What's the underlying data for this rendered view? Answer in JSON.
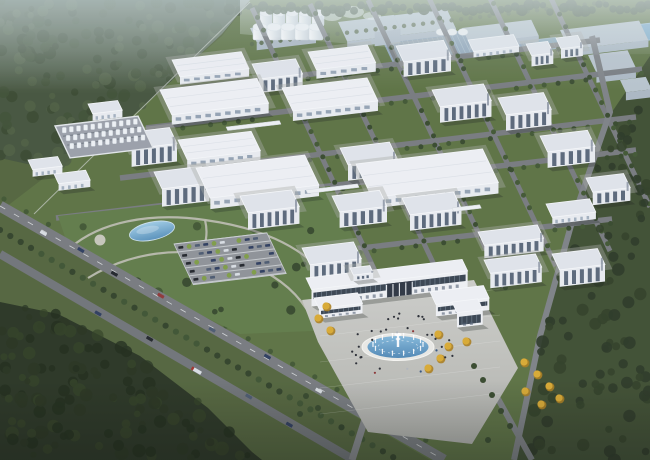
{
  "meta": {
    "description": "Aerial bird's-eye 3D architectural rendering of a large industrial park campus with rows of white factory and office buildings, a silo cluster, a tank yard, a landscaped entrance park with pond and parking lot, a main gate building with oval fountain plaza, tree-lined boulevards and surrounding forest and fields",
    "canvas": {
      "w": 650,
      "h": 460
    }
  },
  "palette": {
    "field": "#51633a",
    "campusGrass": "#5a7040",
    "parkGrass": "#5e7a46",
    "distantBase": "#a7b3b9",
    "distantRoof": "#95a9b8",
    "distantRoofTop": "#b7c3cc",
    "skylight": "#8ba2b6",
    "skylightLine": "#aabfcc",
    "forestTLBase": "#42523a",
    "forestTLDotA": "#36462e",
    "forestTLDotB": "#4b5c40",
    "forestBLBase": "#2c3a26",
    "forestBLDotA": "#22301d",
    "forestBLDotB": "#354627",
    "rightFieldBase": "#3c4c2f",
    "rightFieldDot": "#2e3d24",
    "treelineDot": "#3f503a",
    "road": "#75797d",
    "roadMinor": "#7c8084",
    "roadLane": "#e8eaec",
    "pathGrey": "#b9baae",
    "apron": "#cccdc8",
    "apronEdge": "#b0b1ac",
    "face": "#e8ebf0",
    "faceShade": "#c7cdd7",
    "roofLight": "#eef0f4",
    "roofMid": "#e0e4ea",
    "roofEdge": "#f6f8fa",
    "glass": "#4b5a6e",
    "glassLight": "#8495a8",
    "gateGlass": "#36424f",
    "water": "#4d86b4",
    "waterLight": "#83b8da",
    "pondDistant": "#78a9c8",
    "pondEdge": "#cfe2ee",
    "silo": "#eef2f5",
    "siloShade": "#c9d2d9",
    "yellow": "#d9a930",
    "yellowDark": "#a87c1c",
    "treeDark": "#34472a",
    "treeMid": "#3f5530",
    "bush": "#7d9b44",
    "carNavy": "#2b3a5c",
    "carBlack": "#1e2228",
    "carSlate": "#49586e",
    "carWhite": "#d9dee3",
    "carRed": "#8e3434",
    "truckRed": "#a03028",
    "tankFloor": "#999fa8",
    "pipe": "#6e7680",
    "people": "#262a31",
    "peopleAlt": [
      "#8a3030",
      "#31517c",
      "#b0b6bc"
    ],
    "shadow": "rgba(22,30,24,0.28)",
    "mist": "#cfdde2",
    "steam": "#e9f1f3"
  },
  "basis": {
    "u": [
      0.988,
      -0.118
    ],
    "v": [
      0.42,
      0.885
    ]
  },
  "terrain": {
    "forestTL": [
      [
        0,
        0
      ],
      [
        250,
        0
      ],
      [
        222,
        34
      ],
      [
        166,
        86
      ],
      [
        112,
        134
      ],
      [
        54,
        170
      ],
      [
        0,
        158
      ]
    ],
    "forestBL": [
      [
        0,
        302
      ],
      [
        58,
        314
      ],
      [
        140,
        356
      ],
      [
        208,
        408
      ],
      [
        252,
        452
      ],
      [
        262,
        460
      ],
      [
        0,
        460
      ]
    ],
    "rightField": [
      [
        650,
        56
      ],
      [
        612,
        112
      ],
      [
        574,
        222
      ],
      [
        542,
        336
      ],
      [
        516,
        460
      ],
      [
        650,
        460
      ]
    ],
    "campusPlate": [
      [
        250,
        0
      ],
      [
        650,
        0
      ],
      [
        650,
        56
      ],
      [
        612,
        112
      ],
      [
        574,
        222
      ],
      [
        542,
        336
      ],
      [
        516,
        460
      ],
      [
        430,
        460
      ],
      [
        2,
        210
      ],
      [
        36,
        184
      ],
      [
        96,
        138
      ],
      [
        160,
        90
      ],
      [
        222,
        36
      ]
    ],
    "distantBand": [
      [
        240,
        0
      ],
      [
        650,
        0
      ],
      [
        650,
        54
      ],
      [
        486,
        56
      ],
      [
        240,
        34
      ]
    ]
  },
  "distant": {
    "blocks": [
      [
        "grey",
        338,
        22,
        110,
        22,
        6
      ],
      [
        "grey",
        462,
        28,
        70,
        18,
        6
      ],
      [
        "grey",
        560,
        30,
        80,
        22,
        7
      ],
      [
        "grey",
        588,
        55,
        40,
        20,
        10
      ],
      [
        "grey",
        620,
        80,
        26,
        14,
        8
      ],
      [
        "grey",
        250,
        28,
        60,
        16,
        8
      ],
      [
        "grey",
        368,
        18,
        26,
        16,
        14
      ]
    ],
    "skylightPanel": {
      "o": [
        382,
        40
      ],
      "l": 150,
      "d": 26
    },
    "ponds": [
      {
        "o": [
          534,
          40
        ],
        "l": 22,
        "d": 12
      },
      {
        "o": [
          626,
          26
        ],
        "l": 28,
        "d": 18
      }
    ],
    "silosBack": [
      266,
      279,
      292,
      305,
      318
    ],
    "silosFront": [
      260,
      274,
      288,
      302,
      316
    ],
    "siloYBack": 13,
    "siloYFront": 27,
    "domes": {
      "y": 32,
      "xs": [
        441,
        452,
        463
      ]
    },
    "steam": [
      [
        332,
        16,
        10,
        5
      ],
      [
        352,
        12,
        12,
        6
      ],
      [
        372,
        16,
        9,
        4
      ]
    ]
  },
  "roads": {
    "uRoads": [
      [
        160,
        92,
        600,
        40
      ],
      [
        146,
        128,
        642,
        69
      ],
      [
        120,
        178,
        636,
        117
      ],
      [
        56,
        218,
        636,
        150
      ],
      [
        240,
        262,
        612,
        219
      ]
    ],
    "vRoads": [
      [
        252,
        8,
        384,
        290
      ],
      [
        310,
        4,
        448,
        294
      ],
      [
        368,
        0,
        504,
        287
      ],
      [
        428,
        -4,
        556,
        266
      ],
      [
        488,
        -6,
        610,
        251
      ],
      [
        548,
        -8,
        650,
        207
      ]
    ],
    "perimeterRight": [
      [
        592,
        36
      ],
      [
        610,
        112
      ],
      [
        572,
        222
      ],
      [
        540,
        336
      ],
      [
        514,
        460
      ]
    ],
    "boulevardA": {
      "p0": [
        0,
        206
      ],
      "p1": [
        444,
        460
      ],
      "w": 11
    },
    "boulevardB": {
      "p0": [
        0,
        254
      ],
      "p1": [
        354,
        460
      ],
      "w": 8.5
    },
    "drive": [
      [
        396,
        378
      ],
      [
        372,
        408
      ],
      [
        366,
        416
      ],
      [
        352,
        460
      ]
    ],
    "seRoad": [
      [
        472,
        352
      ],
      [
        532,
        460
      ]
    ],
    "fence": [
      [
        250,
        2
      ],
      [
        34,
        214
      ]
    ]
  },
  "buildings": [
    [
      "wh",
      172,
      60,
      70,
      19,
      8
    ],
    [
      "mid",
      252,
      64,
      44,
      17,
      14
    ],
    [
      "wh",
      308,
      52,
      60,
      20,
      9
    ],
    [
      "mid",
      396,
      46,
      48,
      18,
      15
    ],
    [
      "low",
      468,
      40,
      46,
      13,
      6
    ],
    [
      "mid",
      526,
      44,
      22,
      13,
      11
    ],
    [
      "mid",
      556,
      38,
      22,
      12,
      10
    ],
    [
      "wh",
      160,
      90,
      98,
      28,
      10
    ],
    [
      "wh",
      282,
      88,
      86,
      26,
      10
    ],
    [
      "mid",
      432,
      90,
      52,
      19,
      16
    ],
    [
      "mid",
      498,
      98,
      46,
      19,
      16
    ],
    [
      "mid",
      124,
      133,
      46,
      18,
      18
    ],
    [
      "wh",
      178,
      140,
      74,
      22,
      9
    ],
    [
      "mid",
      154,
      172,
      48,
      19,
      18
    ],
    [
      "wh",
      196,
      168,
      110,
      34,
      11
    ],
    [
      "mid",
      340,
      148,
      50,
      19,
      16
    ],
    [
      "wh",
      356,
      164,
      128,
      38,
      11
    ],
    [
      "mid",
      540,
      136,
      48,
      18,
      16
    ],
    [
      "mid",
      240,
      196,
      52,
      19,
      17
    ],
    [
      "mid",
      332,
      196,
      48,
      18,
      16
    ],
    [
      "mid",
      402,
      198,
      52,
      19,
      16
    ],
    [
      "low",
      546,
      204,
      44,
      15,
      7
    ],
    [
      "mid",
      586,
      178,
      38,
      16,
      13
    ],
    [
      "mid",
      302,
      248,
      52,
      19,
      16
    ],
    [
      "mid",
      478,
      232,
      60,
      15,
      13
    ],
    [
      "mid",
      484,
      260,
      52,
      15,
      15
    ],
    [
      "mid",
      552,
      254,
      46,
      18,
      17
    ],
    [
      "low",
      28,
      160,
      30,
      11,
      7
    ],
    [
      "low",
      54,
      174,
      32,
      11,
      7
    ],
    [
      "low",
      88,
      104,
      30,
      11,
      7
    ]
  ],
  "skybridges": [
    [
      306,
      190,
      52
    ],
    [
      226,
      127,
      54
    ],
    [
      452,
      208,
      28
    ]
  ],
  "tankYard": {
    "o": [
      55,
      126
    ],
    "l": 84,
    "d": 36,
    "rowsV": [
      8,
      17,
      26
    ],
    "stepU": 7.2
  },
  "gate": {
    "rear": [
      306,
      278,
      158,
      13,
      17
    ],
    "penthouse": [
      350,
      268,
      20,
      8,
      6
    ],
    "leftWing": [
      314,
      298,
      44,
      12,
      10
    ],
    "rightWing": [
      430,
      292,
      54,
      14,
      12
    ],
    "tower": [
      452,
      302,
      26,
      12,
      15
    ],
    "opening": {
      "u": 76,
      "w": 26
    }
  },
  "plaza": {
    "poly": [
      [
        302,
        300
      ],
      [
        474,
        280
      ],
      [
        518,
        368
      ],
      [
        472,
        444
      ],
      [
        368,
        432
      ],
      [
        318,
        342
      ]
    ]
  },
  "fountain": {
    "cx": 398,
    "cy": 347,
    "rx": 36,
    "ry": 13.5,
    "jets": 14
  },
  "park": {
    "poly": [
      [
        58,
        216
      ],
      [
        330,
        186
      ],
      [
        366,
        266
      ],
      [
        336,
        330
      ],
      [
        240,
        334
      ],
      [
        150,
        290
      ],
      [
        66,
        240
      ]
    ],
    "pond": {
      "cx": 152,
      "cy": 231,
      "rx": 23,
      "ry": 9,
      "rot": -12
    },
    "paths": [
      "M 70 248 C 100 222 150 212 205 220 C 255 227 300 243 330 280",
      "M 88 278 C 130 252 180 246 228 258 C 268 268 296 288 312 318",
      "M 205 220 C 210 240 202 254 192 268"
    ],
    "circlePlaza": [
      100,
      240,
      5.5
    ]
  },
  "parking": {
    "o": [
      174,
      244
    ],
    "l": 94,
    "d": 46,
    "rows": 5,
    "stepV": 9,
    "stepU": 8.4,
    "carCycle": [
      "carNavy",
      "carBlack",
      "bush",
      "carSlate",
      "carNavy",
      "bush",
      "carWhite",
      "carBlack",
      "bush",
      "carNavy",
      "carSlate"
    ]
  },
  "gatehouse": {
    "x": 358,
    "y": 396,
    "w": 9,
    "h": 6
  },
  "vehiclesA": [
    [
      0.1,
      "carWhite"
    ],
    [
      0.18,
      "carNavy"
    ],
    [
      0.26,
      "carBlack"
    ],
    [
      0.36,
      "carRed"
    ],
    [
      0.48,
      "carSlate"
    ],
    [
      0.6,
      "carNavy"
    ],
    [
      0.72,
      "carWhite"
    ],
    [
      0.84,
      "carBlack"
    ]
  ],
  "vehiclesB": [
    [
      0.28,
      "carNavy"
    ],
    [
      0.42,
      "carBlack"
    ],
    [
      0.56,
      "truck"
    ],
    [
      0.7,
      "carSlate"
    ],
    [
      0.82,
      "carNavy"
    ]
  ],
  "yellowTrees": [
    [
      326,
      306
    ],
    [
      318,
      318
    ],
    [
      330,
      330
    ],
    [
      438,
      334
    ],
    [
      448,
      346
    ],
    [
      440,
      358
    ],
    [
      428,
      368
    ],
    [
      466,
      341
    ],
    [
      524,
      362
    ],
    [
      537,
      374
    ],
    [
      549,
      386
    ],
    [
      559,
      398
    ],
    [
      541,
      404
    ],
    [
      525,
      391
    ]
  ],
  "plazaGreenTrees": [
    [
      474,
      366
    ],
    [
      483,
      380
    ],
    [
      492,
      395
    ],
    [
      501,
      411
    ],
    [
      510,
      426
    ],
    [
      488,
      440
    ],
    [
      306,
      396
    ],
    [
      318,
      408
    ],
    [
      300,
      414
    ]
  ]
}
